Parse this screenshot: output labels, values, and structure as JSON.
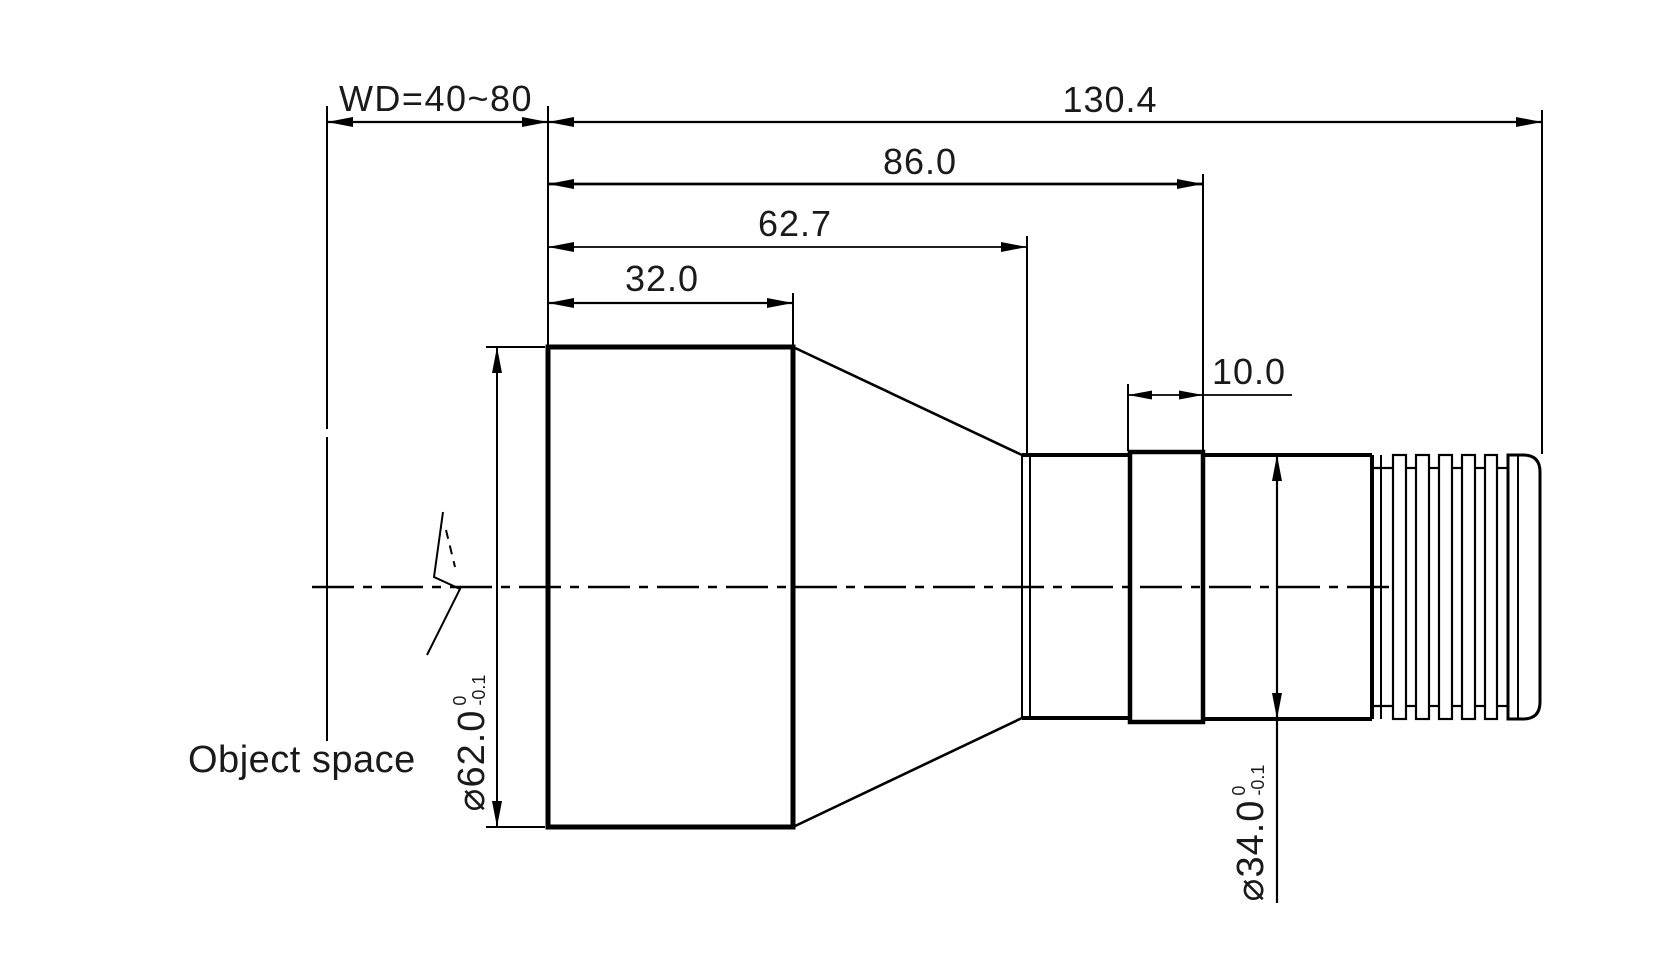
{
  "drawing": {
    "object_space_label": "Object space",
    "dims": {
      "working_distance": "WD=40~80",
      "overall_length": "130.4",
      "body_length": "86.0",
      "cone_section_length": "62.7",
      "front_barrel_length": "32.0",
      "ring_width": "10.0"
    },
    "front_diameter": {
      "value": "⌀62.0",
      "tol_upper": "0",
      "tol_lower": "-0.1"
    },
    "rear_diameter": {
      "value": "⌀34.0",
      "tol_upper": "0",
      "tol_lower": "-0.1"
    },
    "colors": {
      "line": "#000000",
      "text": "#1a1a1a",
      "background": "#ffffff"
    }
  }
}
